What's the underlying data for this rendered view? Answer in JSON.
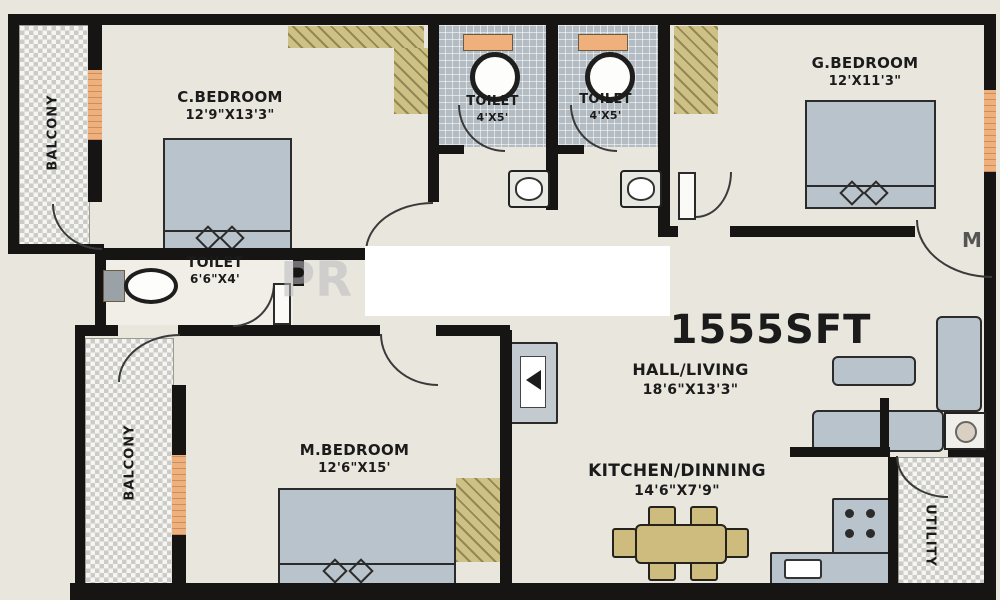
{
  "plan": {
    "total_area": "1555SFT",
    "watermark": {
      "left": "PR",
      "right": "M"
    },
    "rooms": {
      "c_bedroom": {
        "name": "C.BEDROOM",
        "dims": "12'9\"X13'3\""
      },
      "toilet_a": {
        "name": "TOILET",
        "dims": "4'X5'"
      },
      "toilet_b": {
        "name": "TOILET",
        "dims": "4'X5'"
      },
      "g_bedroom": {
        "name": "G.BEDROOM",
        "dims": "12'X11'3\""
      },
      "toilet_c": {
        "name": "TOILET",
        "dims": "6'6\"X4'"
      },
      "m_bedroom": {
        "name": "M.BEDROOM",
        "dims": "12'6\"X15'"
      },
      "hall": {
        "name": "HALL/LIVING",
        "dims": "18'6\"X13'3\""
      },
      "kitchen": {
        "name": "KITCHEN/DINNING",
        "dims": "14'6\"X7'9\""
      },
      "balcony_top": {
        "name": "BALCONY"
      },
      "balcony_bottom": {
        "name": "BALCONY"
      },
      "utility": {
        "name": "UTILITY"
      }
    },
    "colors": {
      "background": "#e9e6dd",
      "wall": "#171513",
      "furniture_gray": "#b9c3cb",
      "wood": "#cdbc7e",
      "window_orange": "#f0b07c",
      "toilet_tile": "#b3bcc2",
      "wardrobe_hatch": "#cec186",
      "watermark_white": "#ffffff"
    }
  }
}
